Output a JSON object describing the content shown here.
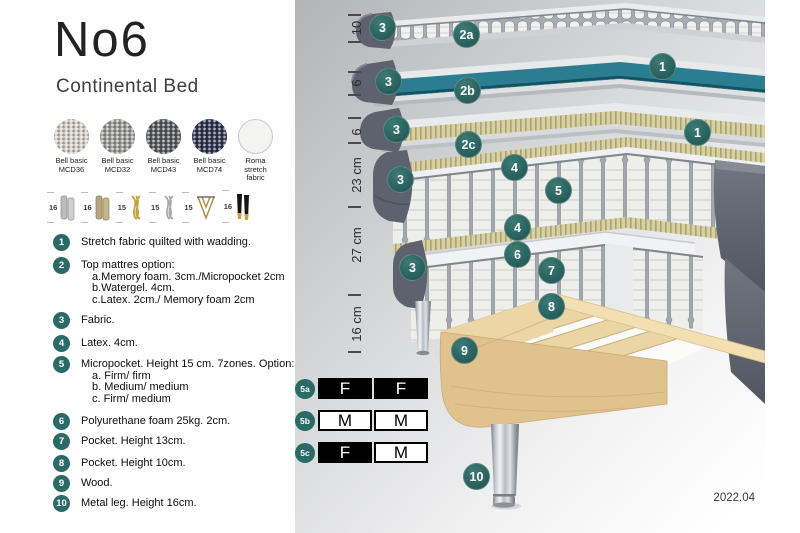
{
  "header": {
    "model": "No6",
    "subtitle": "Continental Bed"
  },
  "fabrics": [
    {
      "line1": "Bell basic",
      "line2": "MCD36",
      "color": "#d6d2c9"
    },
    {
      "line1": "Bell basic",
      "line2": "MCD32",
      "color": "#9e9e9b"
    },
    {
      "line1": "Bell basic",
      "line2": "MCD43",
      "color": "#5a5b5e"
    },
    {
      "line1": "Bell basic",
      "line2": "MCD74",
      "color": "#303550"
    },
    {
      "line1": "Roma",
      "line2": "stretch fabric",
      "color": "#f3f3f1"
    }
  ],
  "leg_options": [
    {
      "height": "16",
      "icon": "cylinder-legs-silver"
    },
    {
      "height": "16",
      "icon": "cylinder-legs-wood"
    },
    {
      "height": "15",
      "icon": "twisted-legs-gold"
    },
    {
      "height": "15",
      "icon": "twisted-legs-silver"
    },
    {
      "height": "15",
      "icon": "hairpin-legs-gold"
    },
    {
      "height": "16",
      "icon": "tapered-legs-black-gold"
    }
  ],
  "legend": [
    {
      "num": "1",
      "text": "Stretch fabric quilted with wadding."
    },
    {
      "num": "2",
      "text": "Top mattres option:",
      "sublines": [
        "a.Memory foam. 3cm./Micropocket 2cm",
        "b.Watergel. 4cm.",
        "c.Latex. 2cm./ Memory foam 2cm"
      ]
    },
    {
      "num": "3",
      "text": "Fabric."
    },
    {
      "num": "4",
      "text": "Latex. 4cm."
    },
    {
      "num": "5",
      "text": "Micropocket. Height 15 cm. 7zones. Option:",
      "sublines": [
        "a. Firm/ firm",
        "b. Medium/ medium",
        "c. Firm/ medium"
      ]
    },
    {
      "num": "6",
      "text": "Polyurethane foam 25kg. 2cm."
    },
    {
      "num": "7",
      "text": "Pocket. Height 13cm."
    },
    {
      "num": "8",
      "text": "Pocket. Height 10cm."
    },
    {
      "num": "9",
      "text": "Wood."
    },
    {
      "num": "10",
      "text": "Metal leg. Height 16cm."
    }
  ],
  "diagram": {
    "measurements": [
      "10",
      "6",
      "6",
      "23 cm",
      "27 cm",
      "16 cm"
    ],
    "callouts": [
      "3",
      "2a",
      "1",
      "3",
      "2b",
      "3",
      "1",
      "2c",
      "4",
      "3",
      "5",
      "4",
      "6",
      "3",
      "7",
      "8",
      "9",
      "10"
    ],
    "firmness": [
      {
        "label": "5a",
        "cells": [
          {
            "value": "F"
          },
          {
            "value": "F"
          }
        ]
      },
      {
        "label": "5b",
        "cells": [
          {
            "value": "M"
          },
          {
            "value": "M"
          }
        ]
      },
      {
        "label": "5c",
        "cells": [
          {
            "value": "F"
          },
          {
            "value": "M"
          }
        ]
      }
    ],
    "version": "2022.04"
  },
  "colors": {
    "accent_teal": "#2b6b67",
    "watergel": "#2b7e92",
    "side_fabric": "#5d626e",
    "wood": "#e6cd9c"
  }
}
